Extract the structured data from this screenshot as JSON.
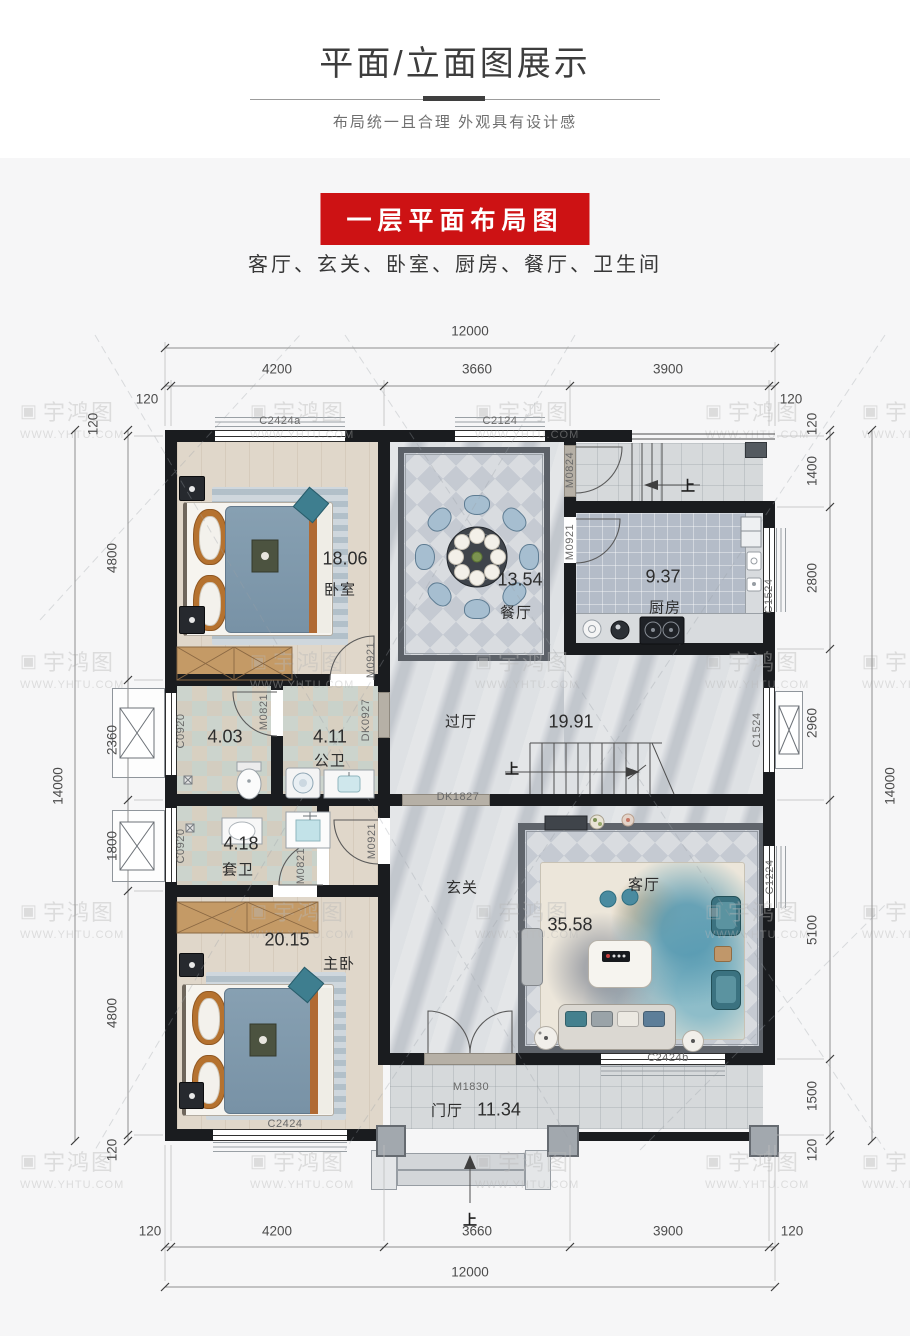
{
  "header": {
    "title": "平面/立面图展示",
    "subtitle": "布局统一且合理  外观具有设计感",
    "banner": "一层平面布局图",
    "rooms_line": "客厅、玄关、卧室、厨房、餐厅、卫生间"
  },
  "watermark": {
    "brand": "宇鸿图",
    "url": "WWW.YHTU.COM",
    "icon": "▣"
  },
  "plan": {
    "rooms": {
      "bedroom1": {
        "name": "卧室",
        "area": "18.06"
      },
      "dining": {
        "name": "餐厅",
        "area": "13.54"
      },
      "kitchen": {
        "name": "厨房",
        "area": "9.37"
      },
      "hall": {
        "name": "过厅",
        "area": "19.91"
      },
      "bath1": {
        "area": "4.03"
      },
      "bath2": {
        "name": "公卫",
        "area": "4.11"
      },
      "ensuite": {
        "name": "套卫",
        "area": "4.18"
      },
      "master": {
        "name": "主卧",
        "area": "20.15"
      },
      "entry": {
        "name": "玄关"
      },
      "living": {
        "name": "客厅",
        "area": "35.58"
      },
      "porch": {
        "name": "门厅",
        "area": "11.34"
      }
    },
    "openings": {
      "c2424a": "C2424a",
      "c2124": "C2124",
      "m0824": "M0824",
      "m0921": "M0921",
      "dk0927": "DK0927",
      "m0821": "M0821",
      "c0920": "C0920",
      "c1524": "C1524",
      "dk1827": "DK1827",
      "c1224": "C1224",
      "c2424b": "C2424b",
      "m1830": "M1830",
      "c2424": "C2424"
    },
    "up": "上",
    "dims": {
      "overall_w": "12000",
      "overall_h": "14000",
      "end": "120",
      "top": [
        "4200",
        "3660",
        "3900"
      ],
      "left": [
        "4800",
        "2360",
        "1800",
        "4800"
      ],
      "right": [
        "1400",
        "2800",
        "2960",
        "5100",
        "1500"
      ],
      "bottom": [
        "4200",
        "3660",
        "3900"
      ]
    }
  }
}
